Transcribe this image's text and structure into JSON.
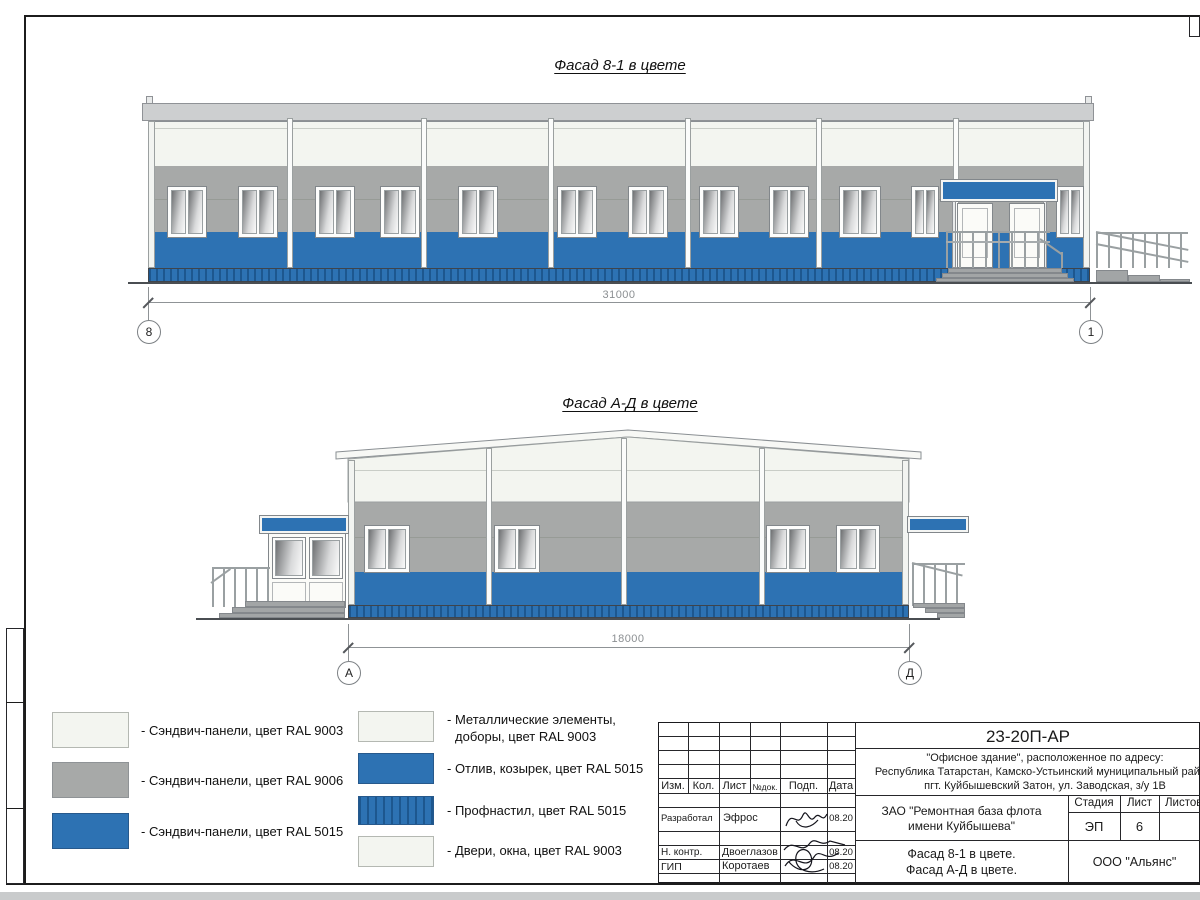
{
  "colors": {
    "ral9003": "#f3f5f0",
    "ral9006": "#a7a9a8",
    "ral5015": "#2d72b3",
    "profnastil_dark": "#1d578f",
    "steps": "#a2a5a6"
  },
  "facade1": {
    "title": "Фасад 8-1 в цвете",
    "dimension": "31000",
    "axis_left": "8",
    "axis_right": "1"
  },
  "facade2": {
    "title": "Фасад А-Д в цвете",
    "dimension": "18000",
    "axis_left": "А",
    "axis_right": "Д"
  },
  "legend": {
    "left": [
      {
        "label": "- Сэндвич-панели, цвет RAL 9003"
      },
      {
        "label": "- Сэндвич-панели, цвет RAL 9006"
      },
      {
        "label": "- Сэндвич-панели, цвет RAL 5015"
      }
    ],
    "right": [
      {
        "label_line1": "- Металлические элементы,",
        "label_line2": "доборы, цвет RAL 9003"
      },
      {
        "label": "- Отлив, козырек, цвет RAL 5015"
      },
      {
        "label": "- Профнастил, цвет RAL 5015"
      },
      {
        "label": "- Двери, окна, цвет RAL 9003"
      }
    ]
  },
  "titleblock": {
    "doc_number": "23-20П-АР",
    "address_line1": "\"Офисное здание\", расположенное по адресу:",
    "address_line2": "Республика Татарстан, Камско-Устьинский муниципальный район,",
    "address_line3": "пгт. Куйбышевский Затон, ул. Заводская, з/у 1В",
    "client_line1": "ЗАО \"Ремонтная база флота",
    "client_line2": "имени Куйбышева\"",
    "col_izm": "Изм.",
    "col_kol": "Кол.",
    "col_list": "Лист",
    "col_ndok": "№док.",
    "col_podp": "Подп.",
    "col_data": "Дата",
    "col_stage": "Стадия",
    "col_sheet": "Лист",
    "col_sheets": "Листов",
    "stage": "ЭП",
    "sheet_num": "6",
    "row_developer_role": "Разработал",
    "row_developer_name": "Эфрос",
    "row_developer_date": "08.20",
    "row_ncontr_role": "Н. контр.",
    "row_ncontr_name": "Двоеглазов",
    "row_ncontr_date": "08.20",
    "row_gip_role": "ГИП",
    "row_gip_name": "Коротаев",
    "row_gip_date": "08.20",
    "title_line1": "Фасад 8-1 в цвете.",
    "title_line2": "Фасад А-Д в цвете.",
    "company": "ООО \"Альянс\""
  }
}
